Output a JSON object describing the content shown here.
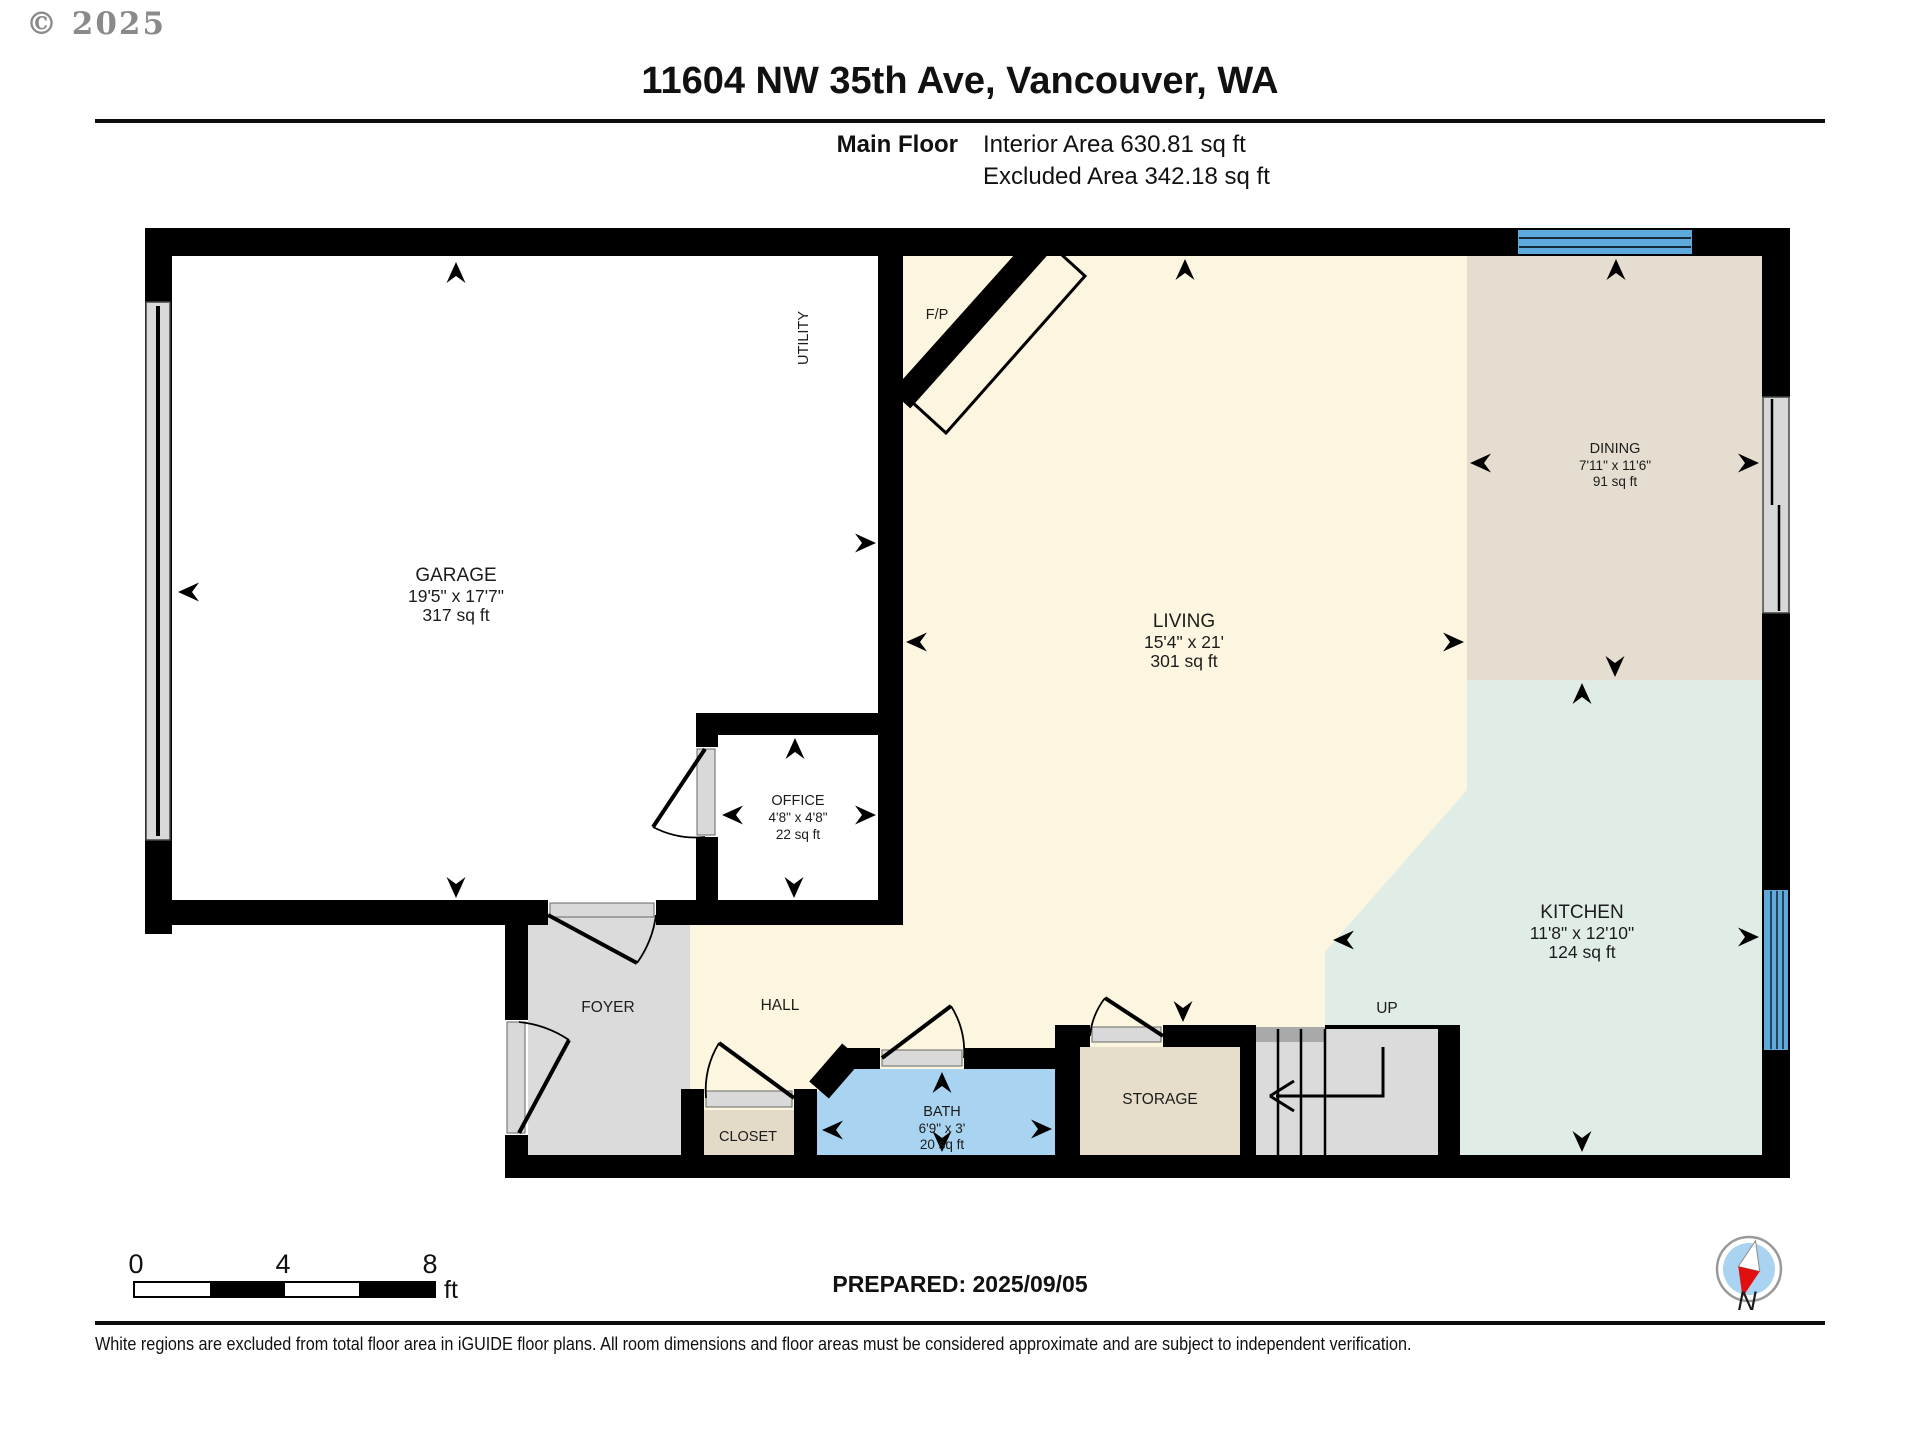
{
  "copyright": "© 2025",
  "header": {
    "title": "11604 NW 35th Ave, Vancouver, WA",
    "floor_label": "Main Floor",
    "interior_area": "Interior Area 630.81 sq ft",
    "excluded_area": "Excluded Area 342.18 sq ft"
  },
  "rooms": {
    "garage": {
      "name": "GARAGE",
      "dims": "19'5\" x 17'7\"",
      "area": "317 sq ft"
    },
    "utility": {
      "name": "UTILITY"
    },
    "fireplace": {
      "name": "F/P"
    },
    "office": {
      "name": "OFFICE",
      "dims": "4'8\" x 4'8\"",
      "area": "22 sq ft"
    },
    "living": {
      "name": "LIVING",
      "dims": "15'4\" x 21'",
      "area": "301 sq ft"
    },
    "dining": {
      "name": "DINING",
      "dims": "7'11\" x 11'6\"",
      "area": "91 sq ft"
    },
    "kitchen": {
      "name": "KITCHEN",
      "dims": "11'8\" x 12'10\"",
      "area": "124 sq ft"
    },
    "foyer": {
      "name": "FOYER"
    },
    "hall": {
      "name": "HALL"
    },
    "closet": {
      "name": "CLOSET"
    },
    "bath": {
      "name": "BATH",
      "dims": "6'9\" x 3'",
      "area": "20 sq ft"
    },
    "storage": {
      "name": "STORAGE"
    },
    "stairs": {
      "name": "UP"
    }
  },
  "scale_bar": {
    "ticks": [
      "0",
      "4",
      "8"
    ],
    "unit": "ft"
  },
  "footer": {
    "prepared": "PREPARED: 2025/09/05",
    "compass_label": "N",
    "disclaimer": "White regions are excluded from total floor area in iGUIDE floor plans. All room dimensions and floor areas must be considered approximate and are subject to independent verification."
  },
  "colors": {
    "wall": "#000000",
    "living_fill": "#FCF5DF",
    "dining_fill": "#E4DDD0",
    "kitchen_fill": "#E0EDE7",
    "bath_fill": "#A9D4F1",
    "storage_fill": "#E6DECA",
    "closet_fill": "#E3DBC7",
    "foyer_fill": "#DBDBDB",
    "stairs_fill": "#DBDBDB",
    "window_fill": "#5FAADC",
    "door_gray": "#D9D9D9",
    "compass_needle_red": "#E01010",
    "compass_face_blue": "#A9D3F0"
  }
}
